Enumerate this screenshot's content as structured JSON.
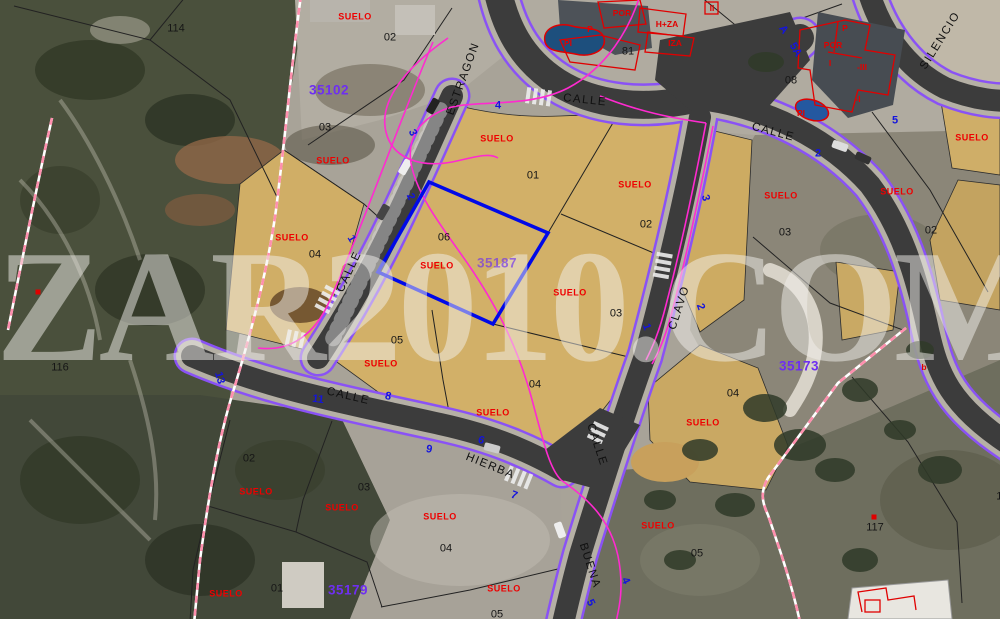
{
  "watermark": {
    "text": "ZAR2010.COM"
  },
  "selected_parcel": {
    "number": "06",
    "code": "35187",
    "outline_color": "#0009e8"
  },
  "colors": {
    "suelo_red": "#ee0000",
    "ref_purple": "#6e2ff0",
    "street_number_blue": "#1414dd",
    "road_edge_purple": "#8a52f5",
    "contour_magenta": "#ff2ad0",
    "boundary_dashed_pink": "#ff8fae",
    "suelo_parcel_tan": "#d2b068"
  },
  "labels": {
    "suelo_labels": {
      "items": [
        [
          "SUELO",
          355,
          17
        ],
        [
          "SUELO",
          333,
          161
        ],
        [
          "SUELO",
          292,
          238
        ],
        [
          "SUELO",
          497,
          139
        ],
        [
          "SUELO",
          635,
          185
        ],
        [
          "SUELO",
          781,
          196
        ],
        [
          "SUELO",
          897,
          192
        ],
        [
          "SUELO",
          972,
          138
        ],
        [
          "SUELO",
          437,
          266
        ],
        [
          "SUELO",
          570,
          293
        ],
        [
          "SUELO",
          381,
          364
        ],
        [
          "SUELO",
          493,
          413
        ],
        [
          "SUELO",
          256,
          492
        ],
        [
          "SUELO",
          342,
          508
        ],
        [
          "SUELO",
          440,
          517
        ],
        [
          "SUELO",
          703,
          423
        ],
        [
          "SUELO",
          658,
          526
        ],
        [
          "SUELO",
          226,
          594
        ],
        [
          "SUELO",
          504,
          589
        ]
      ]
    },
    "parcel_numbers": {
      "items": [
        [
          "114",
          176,
          29
        ],
        [
          "02",
          390,
          38
        ],
        [
          "03",
          325,
          128
        ],
        [
          "04",
          315,
          255
        ],
        [
          "116",
          60,
          368
        ],
        [
          "01",
          533,
          176
        ],
        [
          "02",
          646,
          225
        ],
        [
          "06",
          444,
          238
        ],
        [
          "03",
          616,
          314
        ],
        [
          "05",
          397,
          341
        ],
        [
          "04",
          535,
          385
        ],
        [
          "02",
          931,
          231
        ],
        [
          "03",
          785,
          233
        ],
        [
          "08",
          791,
          81
        ],
        [
          "81",
          628,
          52
        ],
        [
          "04",
          733,
          394
        ],
        [
          "02",
          249,
          459
        ],
        [
          "03",
          364,
          488
        ],
        [
          "04",
          446,
          549
        ],
        [
          "01",
          277,
          589
        ],
        [
          "05",
          497,
          615
        ],
        [
          "05",
          697,
          554
        ],
        [
          "117",
          875,
          528
        ],
        [
          "118",
          1005,
          497
        ]
      ]
    },
    "ref_codes": {
      "items": [
        [
          "35102",
          329,
          90,
          0
        ],
        [
          "35187",
          497,
          263,
          0,
          0.65
        ],
        [
          "35173",
          799,
          366,
          0
        ],
        [
          "35179",
          348,
          590,
          0
        ]
      ]
    },
    "street_names": {
      "items": [
        [
          "ESTRAGON",
          464,
          79,
          -70
        ],
        [
          "CALLE",
          585,
          101,
          6
        ],
        [
          "CALLE",
          773,
          133,
          15
        ],
        [
          "SILENCIO",
          941,
          41,
          -58
        ],
        [
          "CALLE",
          350,
          272,
          -65
        ],
        [
          "CALLE",
          348,
          397,
          13
        ],
        [
          "HIERBA",
          490,
          467,
          22
        ],
        [
          "CALLE",
          596,
          445,
          72
        ],
        [
          "BUENA",
          589,
          566,
          72
        ],
        [
          "CLAVO",
          680,
          308,
          -72
        ]
      ]
    },
    "street_numbers": {
      "items": [
        [
          "4",
          498,
          106,
          0
        ],
        [
          "3",
          412,
          133,
          65
        ],
        [
          "2",
          410,
          197,
          65
        ],
        [
          "1",
          351,
          239,
          60
        ],
        [
          "3",
          705,
          198,
          75
        ],
        [
          "2",
          700,
          307,
          70
        ],
        [
          "1",
          646,
          327,
          70
        ],
        [
          "A",
          783,
          30,
          55
        ],
        [
          "5A",
          795,
          50,
          60
        ],
        [
          "2",
          818,
          154,
          0
        ],
        [
          "5",
          895,
          121,
          0
        ],
        [
          "13",
          219,
          378,
          75
        ],
        [
          "11",
          318,
          400,
          8
        ],
        [
          "8",
          388,
          397,
          12
        ],
        [
          "9",
          429,
          450,
          12
        ],
        [
          "6",
          481,
          441,
          20
        ],
        [
          "7",
          514,
          496,
          20
        ],
        [
          "4",
          625,
          581,
          65
        ],
        [
          "5",
          590,
          603,
          65
        ]
      ]
    },
    "building_labels": {
      "items": [
        [
          "POR",
          622,
          13
        ],
        [
          "H+ZA",
          667,
          24
        ],
        [
          "IZA",
          675,
          43
        ],
        [
          "P",
          590,
          29
        ],
        [
          "PI",
          568,
          43
        ],
        [
          "II",
          712,
          8
        ],
        [
          "P",
          845,
          28
        ],
        [
          "POR",
          833,
          45
        ],
        [
          "I",
          830,
          63
        ],
        [
          "-III",
          862,
          67
        ],
        [
          "-I",
          858,
          99
        ],
        [
          "PI",
          801,
          113
        ],
        [
          "b",
          924,
          367
        ]
      ]
    },
    "markers": {
      "items": [
        [
          "",
          874,
          517
        ],
        [
          "",
          38,
          292
        ]
      ]
    }
  }
}
